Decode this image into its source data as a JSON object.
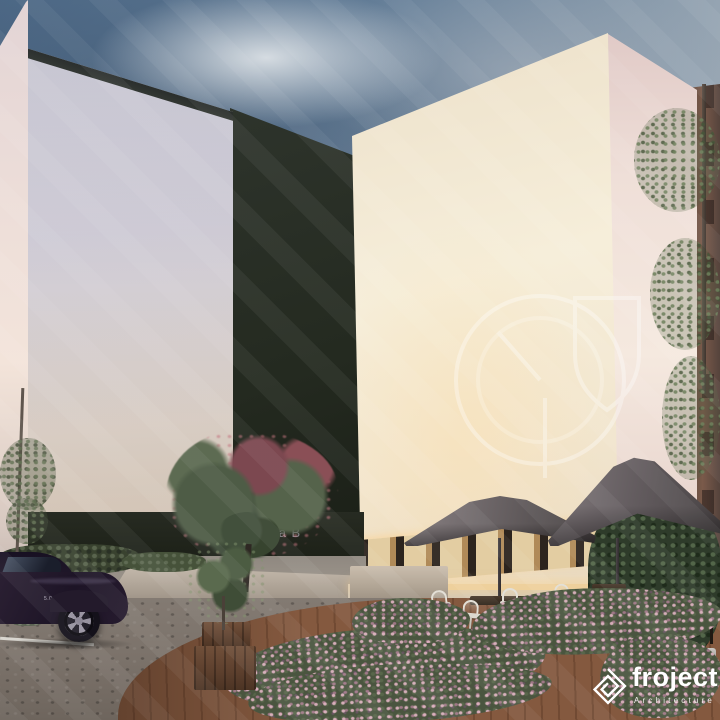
{
  "title": "Residential complex dusk exterior rendering",
  "branding": {
    "logo_text": "froject",
    "logo_subtitle": "Architecture",
    "logo_icon": "square-maze-icon",
    "watermark_icon": "circle-shield-emblem-watermark"
  },
  "signage": {
    "entrance_label": "yrja B"
  },
  "vehicle": {
    "fender_badge": "5.0"
  },
  "scene": {
    "buildings": {
      "left": {
        "floors": 8,
        "bays": 5,
        "facade": "light-lavender"
      },
      "center": {
        "floors": 7,
        "bays": 4,
        "facade": "dark-charcoal"
      },
      "right": {
        "floors": 9,
        "bays": 6,
        "facade": "warm-cream"
      }
    },
    "umbrellas": 2,
    "cafe_chairs": 7,
    "stools": 2,
    "planter_boxes": 2
  },
  "palette": {
    "skyTop": "#4e6a88",
    "skyLight": "#a9b3bc",
    "facadeLeft": "#d2ced8",
    "facadeDark": "#242a20",
    "facadeRight": "#f6eeda",
    "sideWall": "#f5e9df",
    "brick": "#7a5a4a",
    "umbrella": "#6e6769",
    "deck": "#84593f",
    "flower": "#c77f95",
    "pavement": "#c6b8a6",
    "cobble": "#7b726a",
    "carBody": "#1d1426",
    "windowGlow": "#e4b478"
  }
}
